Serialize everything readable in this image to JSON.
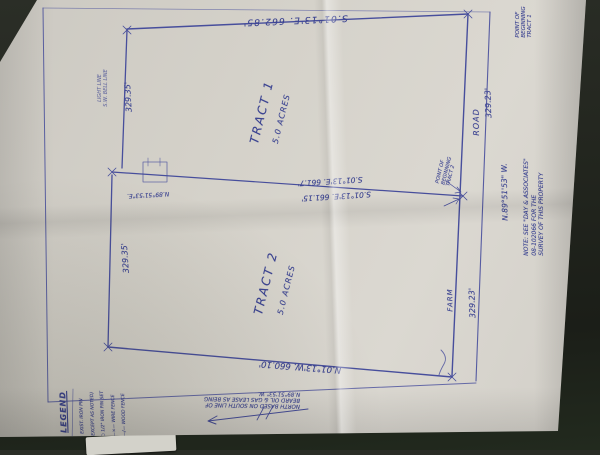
{
  "colors": {
    "background": "#21241d",
    "paper": "#d5d2ca",
    "ink": "#3b4391"
  },
  "tracts": [
    {
      "name": "TRACT 1",
      "area": "5.0 ACRES"
    },
    {
      "name": "TRACT 2",
      "area": "5.0 ACRES"
    }
  ],
  "boundaries": {
    "north_line": "S.01°13'E. 662.85'",
    "middle_line_upper": "S.01°13'E. 661.7'",
    "middle_line_lower": "S.01°13'E. 661.15'",
    "middle_left_bearing": "N.89°51'53\"E.",
    "south_line": "N.01°13'W. 660.10'",
    "tract1_west_dim": "329.35'",
    "tract2_west_dim": "329.35'",
    "tract1_road_frontage": "329.23'",
    "tract2_road_frontage": "329.23'",
    "road_bearing": "N.89°51'53\" W."
  },
  "road": {
    "label_upper": "ROAD",
    "label_lower": "FARM"
  },
  "notes": {
    "pob_mid": [
      "POINT OF",
      "BEGINNING",
      "TRACT 2"
    ],
    "pob_top": [
      "POINT OF",
      "BEGINNING",
      "TRACT 1"
    ],
    "margin_note": [
      "NOTE: SEE \"DAY & ASSOCIATES\"",
      "08-102066 FOR THE",
      "SURVEY OF THIS PROPERTY"
    ],
    "north_note": [
      "NORTH BASED ON SOUTH LINE OF",
      "BEARD OIL & GAS LEASE AS BEING",
      "N.89°51'53\" W."
    ],
    "utility_note": [
      "LIGHT LINE",
      "S.W. BELL LINE"
    ]
  },
  "legend": {
    "title": "LEGEND",
    "items": [
      "• EXIST. IRON PIN",
      "(EXCEPT AS NOTED)",
      "○ 1/2\" IRON PIN SET",
      "—×— WIRE FENCE",
      "—/— WOOD FENCE"
    ]
  }
}
